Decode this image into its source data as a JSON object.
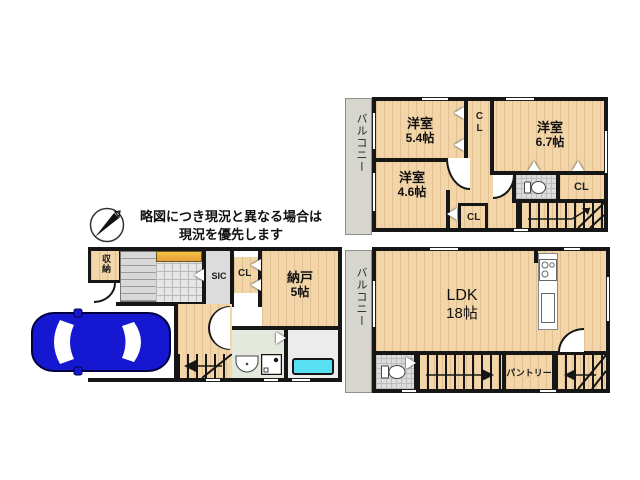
{
  "note": {
    "line1": "略図につき現況と異なる場合は",
    "line2": "現況を優先します"
  },
  "upper_plan": {
    "balcony": "バルコニー",
    "room_nw": {
      "name": "洋室",
      "size": "5.4帖"
    },
    "room_ne": {
      "name": "洋室",
      "size": "6.7帖"
    },
    "room_sw": {
      "name": "洋室",
      "size": "4.6帖"
    },
    "closet_top": "CL",
    "closet_right": "CL",
    "closet_bottom": "CL"
  },
  "lower_plan": {
    "balcony": "バルコニー",
    "ldk": {
      "name": "LDK",
      "size": "18帖"
    },
    "pantry": "パントリー"
  },
  "first_plan": {
    "storage": "収納",
    "shoe_closet": "SIC",
    "closet": "CL",
    "nando": {
      "name": "納戸",
      "size": "5帖"
    }
  },
  "colors": {
    "wood_floor": "#F2D5A8",
    "balcony_gray": "#D6D6CE",
    "wall_black": "#161616",
    "bathtub_cyan": "#57DFF2",
    "car_blue": "#1518D0",
    "porch_yellow": "#F5C542"
  }
}
